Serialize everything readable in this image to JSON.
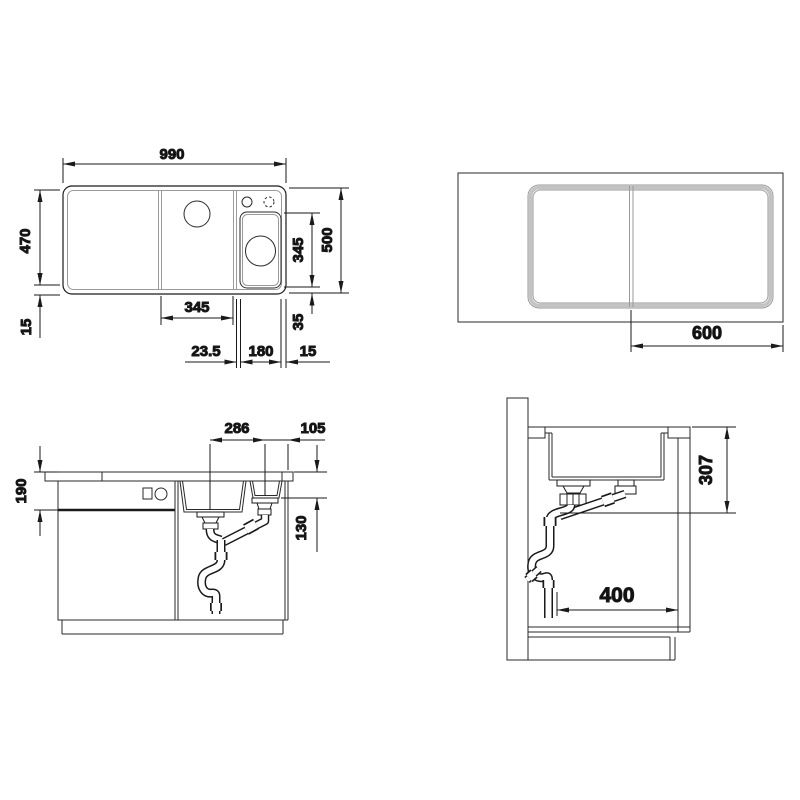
{
  "colors": {
    "line": "#1a1a1a",
    "secondary_line": "#9a9a9a",
    "background": "#ffffff"
  },
  "views": {
    "sink_top": {
      "dims": {
        "overall_width": "990",
        "inner_depth": "470",
        "bottom_rim": "15",
        "main_bowl_width": "345",
        "small_bowl_length": "345",
        "overall_depth": "500",
        "small_bowl_bottom_gap": "35",
        "bowl_divider": "23.5",
        "small_bowl_width": "180",
        "right_rim": "15"
      }
    },
    "board_top": {
      "dims": {
        "board_to_edge": "600"
      }
    },
    "front_section": {
      "dims": {
        "drain_spacing": "286",
        "drain_to_edge": "105",
        "worktop_clearance": "190",
        "small_bowl_depth": "130"
      }
    },
    "side_section": {
      "dims": {
        "outlet_depth": "307",
        "cabinet_clearance": "400"
      }
    }
  }
}
